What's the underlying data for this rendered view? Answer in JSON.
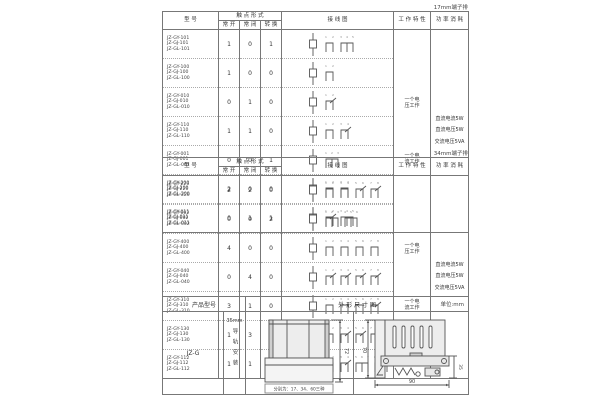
{
  "page": {
    "bg": "#ffffff",
    "border_color": "#777777",
    "text_color": "#333333",
    "accent": "#555555"
  },
  "table1": {
    "corner_label": "17mm端子排",
    "headers": {
      "model": "型  号",
      "contact_form": "触 点 形 式",
      "no": "常 开",
      "nc": "常 闭",
      "co": "转 换",
      "diagram": "接  线  图",
      "characteristic": "工 作 特 性",
      "power": "功 率 消 耗"
    },
    "rows": [
      {
        "models": [
          "JZ-GY-101",
          "JZ-GJ-101",
          "JZ-GL-101"
        ],
        "no": 1,
        "nc": 0,
        "co": 1
      },
      {
        "models": [
          "JZ-GY-100",
          "JZ-GJ-100",
          "JZ-GL-100"
        ],
        "no": 1,
        "nc": 0,
        "co": 0
      },
      {
        "models": [
          "JZ-GY-010",
          "JZ-GJ-010",
          "JZ-GL-010"
        ],
        "no": 0,
        "nc": 1,
        "co": 0
      },
      {
        "models": [
          "JZ-GY-110",
          "JZ-GJ-110",
          "JZ-GL-110"
        ],
        "no": 1,
        "nc": 1,
        "co": 0
      },
      {
        "models": [
          "JZ-GY-001",
          "JZ-GJ-001",
          "JZ-GL-001"
        ],
        "no": 0,
        "nc": 0,
        "co": 1
      },
      {
        "models": [
          "JZ-GY-200",
          "JZ-GJ-200",
          "JZ-GL-200"
        ],
        "no": 2,
        "nc": 0,
        "co": 0
      },
      {
        "models": [
          "JZ-GY-011",
          "JZ-GJ-011",
          "JZ-GL-011"
        ],
        "no": 0,
        "nc": 1,
        "co": 1
      }
    ],
    "characteristics": [
      "一个电\n压工作",
      "一个电\n流工作"
    ],
    "power_lines": [
      "直流电流5W",
      "直流电压5W",
      "交流电压5VA"
    ]
  },
  "table2": {
    "corner_label": "34mm端子排",
    "headers": {
      "model": "型  号",
      "contact_form": "触 点 形 式",
      "no": "常 开",
      "nc": "常 闭",
      "co": "转 换",
      "diagram": "接  线  图",
      "characteristic": "工 作 特 性",
      "power": "功 率 消 耗"
    },
    "rows": [
      {
        "models": [
          "JZ-GY-220",
          "JZ-GJ-220",
          "JZ-GL-220"
        ],
        "no": 2,
        "nc": 2,
        "co": 0
      },
      {
        "models": [
          "JZ-GY-002",
          "JZ-GJ-002",
          "JZ-GL-002"
        ],
        "no": 0,
        "nc": 0,
        "co": 2
      },
      {
        "models": [
          "JZ-GY-400",
          "JZ-GJ-400",
          "JZ-GL-400"
        ],
        "no": 4,
        "nc": 0,
        "co": 0
      },
      {
        "models": [
          "JZ-GY-040",
          "JZ-GJ-040",
          "JZ-GL-040"
        ],
        "no": 0,
        "nc": 4,
        "co": 0
      },
      {
        "models": [
          "JZ-GY-310",
          "JZ-GJ-310",
          "JZ-GL-310"
        ],
        "no": 3,
        "nc": 1,
        "co": 0
      },
      {
        "models": [
          "JZ-GY-130",
          "JZ-GJ-130",
          "JZ-GL-130"
        ],
        "no": 1,
        "nc": 3,
        "co": 0
      },
      {
        "models": [
          "JZ-GY-112",
          "JZ-GJ-112",
          "JZ-GL-112"
        ],
        "no": 1,
        "nc": 1,
        "co": 2
      }
    ],
    "characteristics": [
      "一个电\n压工作",
      "一个电\n流工作"
    ],
    "power_lines": [
      "直流电流5W",
      "直流电压5W",
      "交流电压5VA"
    ]
  },
  "table3": {
    "headers": {
      "model": "产品型号",
      "dimension": "外 形 尺 寸 图",
      "unit": "单位:mm"
    },
    "model": "JZ-G",
    "mount_top": "35mm",
    "mount_vertical": "导轨安装",
    "front_view": {
      "height_dim": "72",
      "caption": "分别为：17、34、60三种"
    },
    "side_view": {
      "height_dim": "70",
      "width_dim": "90",
      "rail_dim": "35"
    }
  }
}
